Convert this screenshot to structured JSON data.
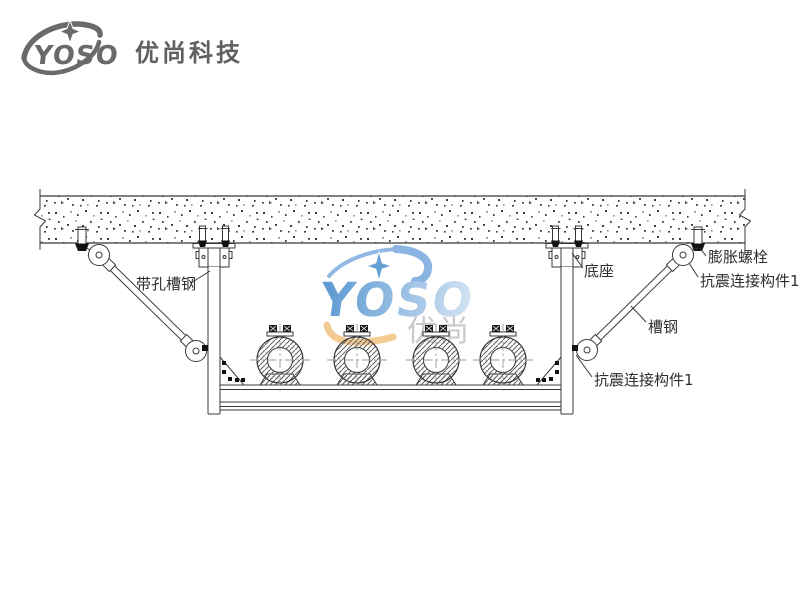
{
  "header": {
    "logo_text": "YOSO",
    "company_name": "优尚科技"
  },
  "watermark": {
    "logo_text": "YOSO",
    "logo_subtext": "优尚"
  },
  "diagram": {
    "labels": {
      "perforated_channel": "带孔槽钢",
      "base_mount": "底座",
      "expansion_bolt": "膨胀螺栓",
      "seismic_connector_top": "抗震连接构件1",
      "channel_steel": "槽钢",
      "seismic_connector_bottom": "抗震连接构件1"
    },
    "pipes": {
      "count": 4,
      "centers_x": [
        280,
        357,
        436,
        503
      ],
      "center_y": 360
    }
  },
  "colors": {
    "line": "#383838",
    "logo_gray": "#6a6a6a",
    "watermark_blue_dark": "#4f92cf",
    "watermark_blue_light": "#d3e3f4",
    "watermark_orange": "#f4ca8e",
    "watermark_gray": "#c7c7c7"
  }
}
